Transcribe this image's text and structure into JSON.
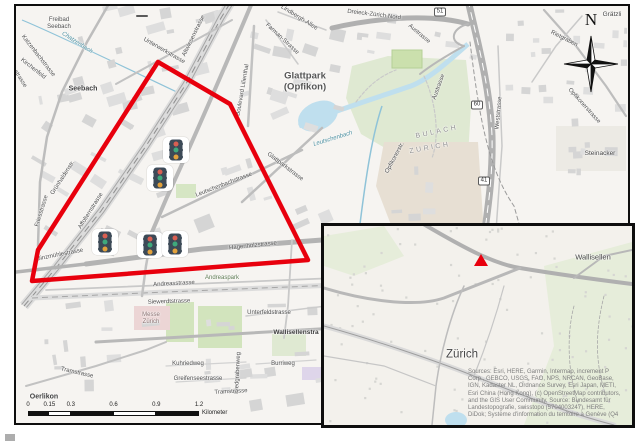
{
  "figure": {
    "description": "Map figure of Zurich Oerlikon / Glattpark area with study-area polygon, traffic-signal symbols, north arrow, scale bar and locator inset"
  },
  "colors": {
    "polygon": "#e8000d",
    "marker": "#e8000d",
    "water": "#bfdfee",
    "green": "#dfe9d2",
    "black": "#111111"
  },
  "main_map": {
    "compass": {
      "label": "N"
    },
    "polygon_points": "142,56 214,98 292,254 16,275 22,244",
    "traffic_lights": [
      {
        "x": 160,
        "y": 144
      },
      {
        "x": 144,
        "y": 172
      },
      {
        "x": 89,
        "y": 236
      },
      {
        "x": 134,
        "y": 239
      },
      {
        "x": 159,
        "y": 238
      }
    ],
    "shields": [
      {
        "label": "51",
        "x": 424,
        "y": 6
      },
      {
        "label": "60",
        "x": 461,
        "y": 99
      },
      {
        "label": "41",
        "x": 468,
        "y": 175
      },
      {
        "label": "",
        "x": 126,
        "y": 10
      }
    ],
    "scale_bar": {
      "tick_labels": [
        "0",
        "0.15",
        "0.3",
        "0.6",
        "0.9",
        "1.2"
      ],
      "ticks_km": [
        0,
        0.15,
        0.3,
        0.6,
        0.9,
        1.2
      ],
      "unit": "Kilometer",
      "total_km": 1.2
    },
    "labels": [
      {
        "t": "Freibad",
        "x": 43,
        "y": 14,
        "s": 6
      },
      {
        "t": "Seebach",
        "x": 43,
        "y": 21,
        "s": 6
      },
      {
        "t": "Chatzenbach",
        "x": 61,
        "y": 37,
        "r": 33,
        "s": 6,
        "c": "#4b8fa0",
        "i": 1
      },
      {
        "t": "Katzenbachstrasse",
        "x": 22,
        "y": 50,
        "r": 52,
        "s": 6
      },
      {
        "t": "Kirchenfeld",
        "x": 17,
        "y": 63,
        "r": 38,
        "s": 6
      },
      {
        "t": "strasse",
        "x": 4,
        "y": 73,
        "r": 58,
        "s": 6
      },
      {
        "t": "Seebach",
        "x": 67,
        "y": 83,
        "s": 7,
        "c": "#3f3f3f",
        "w": 1
      },
      {
        "t": "Unterwerkstrasse",
        "x": 148,
        "y": 45,
        "r": 30,
        "s": 6
      },
      {
        "t": "Altwiesenstrasse",
        "x": 178,
        "y": 30,
        "r": -64,
        "s": 6
      },
      {
        "t": "Farman-Strasse",
        "x": 266,
        "y": 33,
        "r": 43,
        "s": 6
      },
      {
        "t": "Lindbergh-Allee",
        "x": 283,
        "y": 12,
        "r": 32,
        "s": 6
      },
      {
        "t": "Boulevard Lilienthal",
        "x": 227,
        "y": 84,
        "r": -80,
        "s": 6
      },
      {
        "t": "Glattpark",
        "x": 289,
        "y": 70,
        "s": 9.5,
        "c": "#555555",
        "w": 1
      },
      {
        "t": "(Opfikon)",
        "x": 289,
        "y": 81,
        "s": 9.5,
        "c": "#555555",
        "w": 1
      },
      {
        "t": "Dreieck-Zürich-Nord",
        "x": 358,
        "y": 9,
        "r": 7,
        "s": 6
      },
      {
        "t": "Grätzli",
        "x": 596,
        "y": 9,
        "s": 6.5,
        "c": "#454545"
      },
      {
        "t": "Austrasse",
        "x": 403,
        "y": 28,
        "r": 40,
        "s": 6
      },
      {
        "t": "Austrasse",
        "x": 423,
        "y": 81,
        "r": -70,
        "s": 6
      },
      {
        "t": "Rietgraben",
        "x": 548,
        "y": 33,
        "r": 27,
        "s": 6
      },
      {
        "t": "Opfikonerstrasse",
        "x": 568,
        "y": 100,
        "r": 48,
        "s": 6
      },
      {
        "t": "Steinacker",
        "x": 584,
        "y": 148,
        "s": 6.5,
        "c": "#454545"
      },
      {
        "t": "Weststrasse",
        "x": 483,
        "y": 107,
        "r": -85,
        "s": 6
      },
      {
        "t": "BULACH",
        "x": 421,
        "y": 126,
        "r": -12,
        "s": 7,
        "c": "#909090",
        "sp": 2.5
      },
      {
        "t": "ZURICH",
        "x": 414,
        "y": 142,
        "r": -10,
        "s": 7,
        "c": "#909090",
        "sp": 2.5
      },
      {
        "t": "Leutschenbach",
        "x": 317,
        "y": 133,
        "r": -17,
        "s": 6,
        "c": "#4b8fa0",
        "i": 1
      },
      {
        "t": "Glattparkstrasse",
        "x": 269,
        "y": 161,
        "r": 37,
        "s": 6
      },
      {
        "t": "Leutschenbachstrasse",
        "x": 208,
        "y": 179,
        "r": -21,
        "s": 6
      },
      {
        "t": "Hagenholzstrasse",
        "x": 237,
        "y": 240,
        "r": -6,
        "s": 6
      },
      {
        "t": "Grünhaldenstr.",
        "x": 47,
        "y": 172,
        "r": -57,
        "s": 6
      },
      {
        "t": "Friesstrasse",
        "x": 26,
        "y": 205,
        "r": -73,
        "s": 6
      },
      {
        "t": "Affolternstrasse",
        "x": 75,
        "y": 205,
        "r": -58,
        "s": 6
      },
      {
        "t": "Binzmühlestrasse",
        "x": 44,
        "y": 249,
        "r": -11,
        "s": 6
      },
      {
        "t": "Andreasstrasse",
        "x": 158,
        "y": 278,
        "r": -3,
        "s": 6
      },
      {
        "t": "Andreaspark",
        "x": 206,
        "y": 272,
        "s": 6,
        "c": "#5d7a52"
      },
      {
        "t": "Siewerdtstrasse",
        "x": 153,
        "y": 296,
        "r": -2,
        "s": 6
      },
      {
        "t": "Messe",
        "x": 135,
        "y": 309,
        "s": 6,
        "c": "#8a7070"
      },
      {
        "t": "Zürich",
        "x": 135,
        "y": 316,
        "s": 6,
        "c": "#8a7070"
      },
      {
        "t": "Unterfeldstrasse",
        "x": 253,
        "y": 307,
        "s": 6
      },
      {
        "t": "Wallisellenstra",
        "x": 280,
        "y": 327,
        "s": 6.5,
        "c": "#3a3a3a",
        "w": 1
      },
      {
        "t": "Kuhriedweg",
        "x": 172,
        "y": 358,
        "s": 6
      },
      {
        "t": "Riedgrabenweg",
        "x": 222,
        "y": 367,
        "r": -87,
        "s": 6
      },
      {
        "t": "Burriweg",
        "x": 267,
        "y": 358,
        "s": 6
      },
      {
        "t": "Greifenseestrasse",
        "x": 182,
        "y": 373,
        "s": 6
      },
      {
        "t": "Tramstrasse",
        "x": 61,
        "y": 367,
        "r": 13,
        "s": 6
      },
      {
        "t": "Tramstrasse",
        "x": 215,
        "y": 386,
        "r": -3,
        "s": 6
      },
      {
        "t": "Oerlikon",
        "x": 28,
        "y": 391,
        "s": 7,
        "c": "#3f3f3f",
        "w": 1
      },
      {
        "t": "Opfikonerstr.",
        "x": 379,
        "y": 152,
        "r": -62,
        "s": 6
      }
    ]
  },
  "inset": {
    "labels": [
      {
        "t": "Wallisellen",
        "x": 269,
        "y": 31,
        "s": 7.5,
        "c": "#454545"
      },
      {
        "t": "Zürich",
        "x": 138,
        "y": 129,
        "s": 11.5,
        "c": "#454545"
      }
    ],
    "marker": {
      "shape": "triangle",
      "x": 157,
      "y": 34
    },
    "attribution_lines": [
      "Sources: Esri, HERE, Garmin, Intermap, increment P",
      "Corp., GEBCO, USGS, FAO, NPS, NRCAN, GeoBase,",
      "IGN, Kadaster NL, Ordnance Survey, Esri Japan, METI,",
      "Esri China (Hong Kong), (c) OpenStreetMap contributors,",
      "and the GIS User Community, Source: Bundesamt für",
      "Landestopografie, swisstopo (5704003247), HERE,",
      "DiDok; Système d'information du territoire à Genève (Q4"
    ]
  }
}
